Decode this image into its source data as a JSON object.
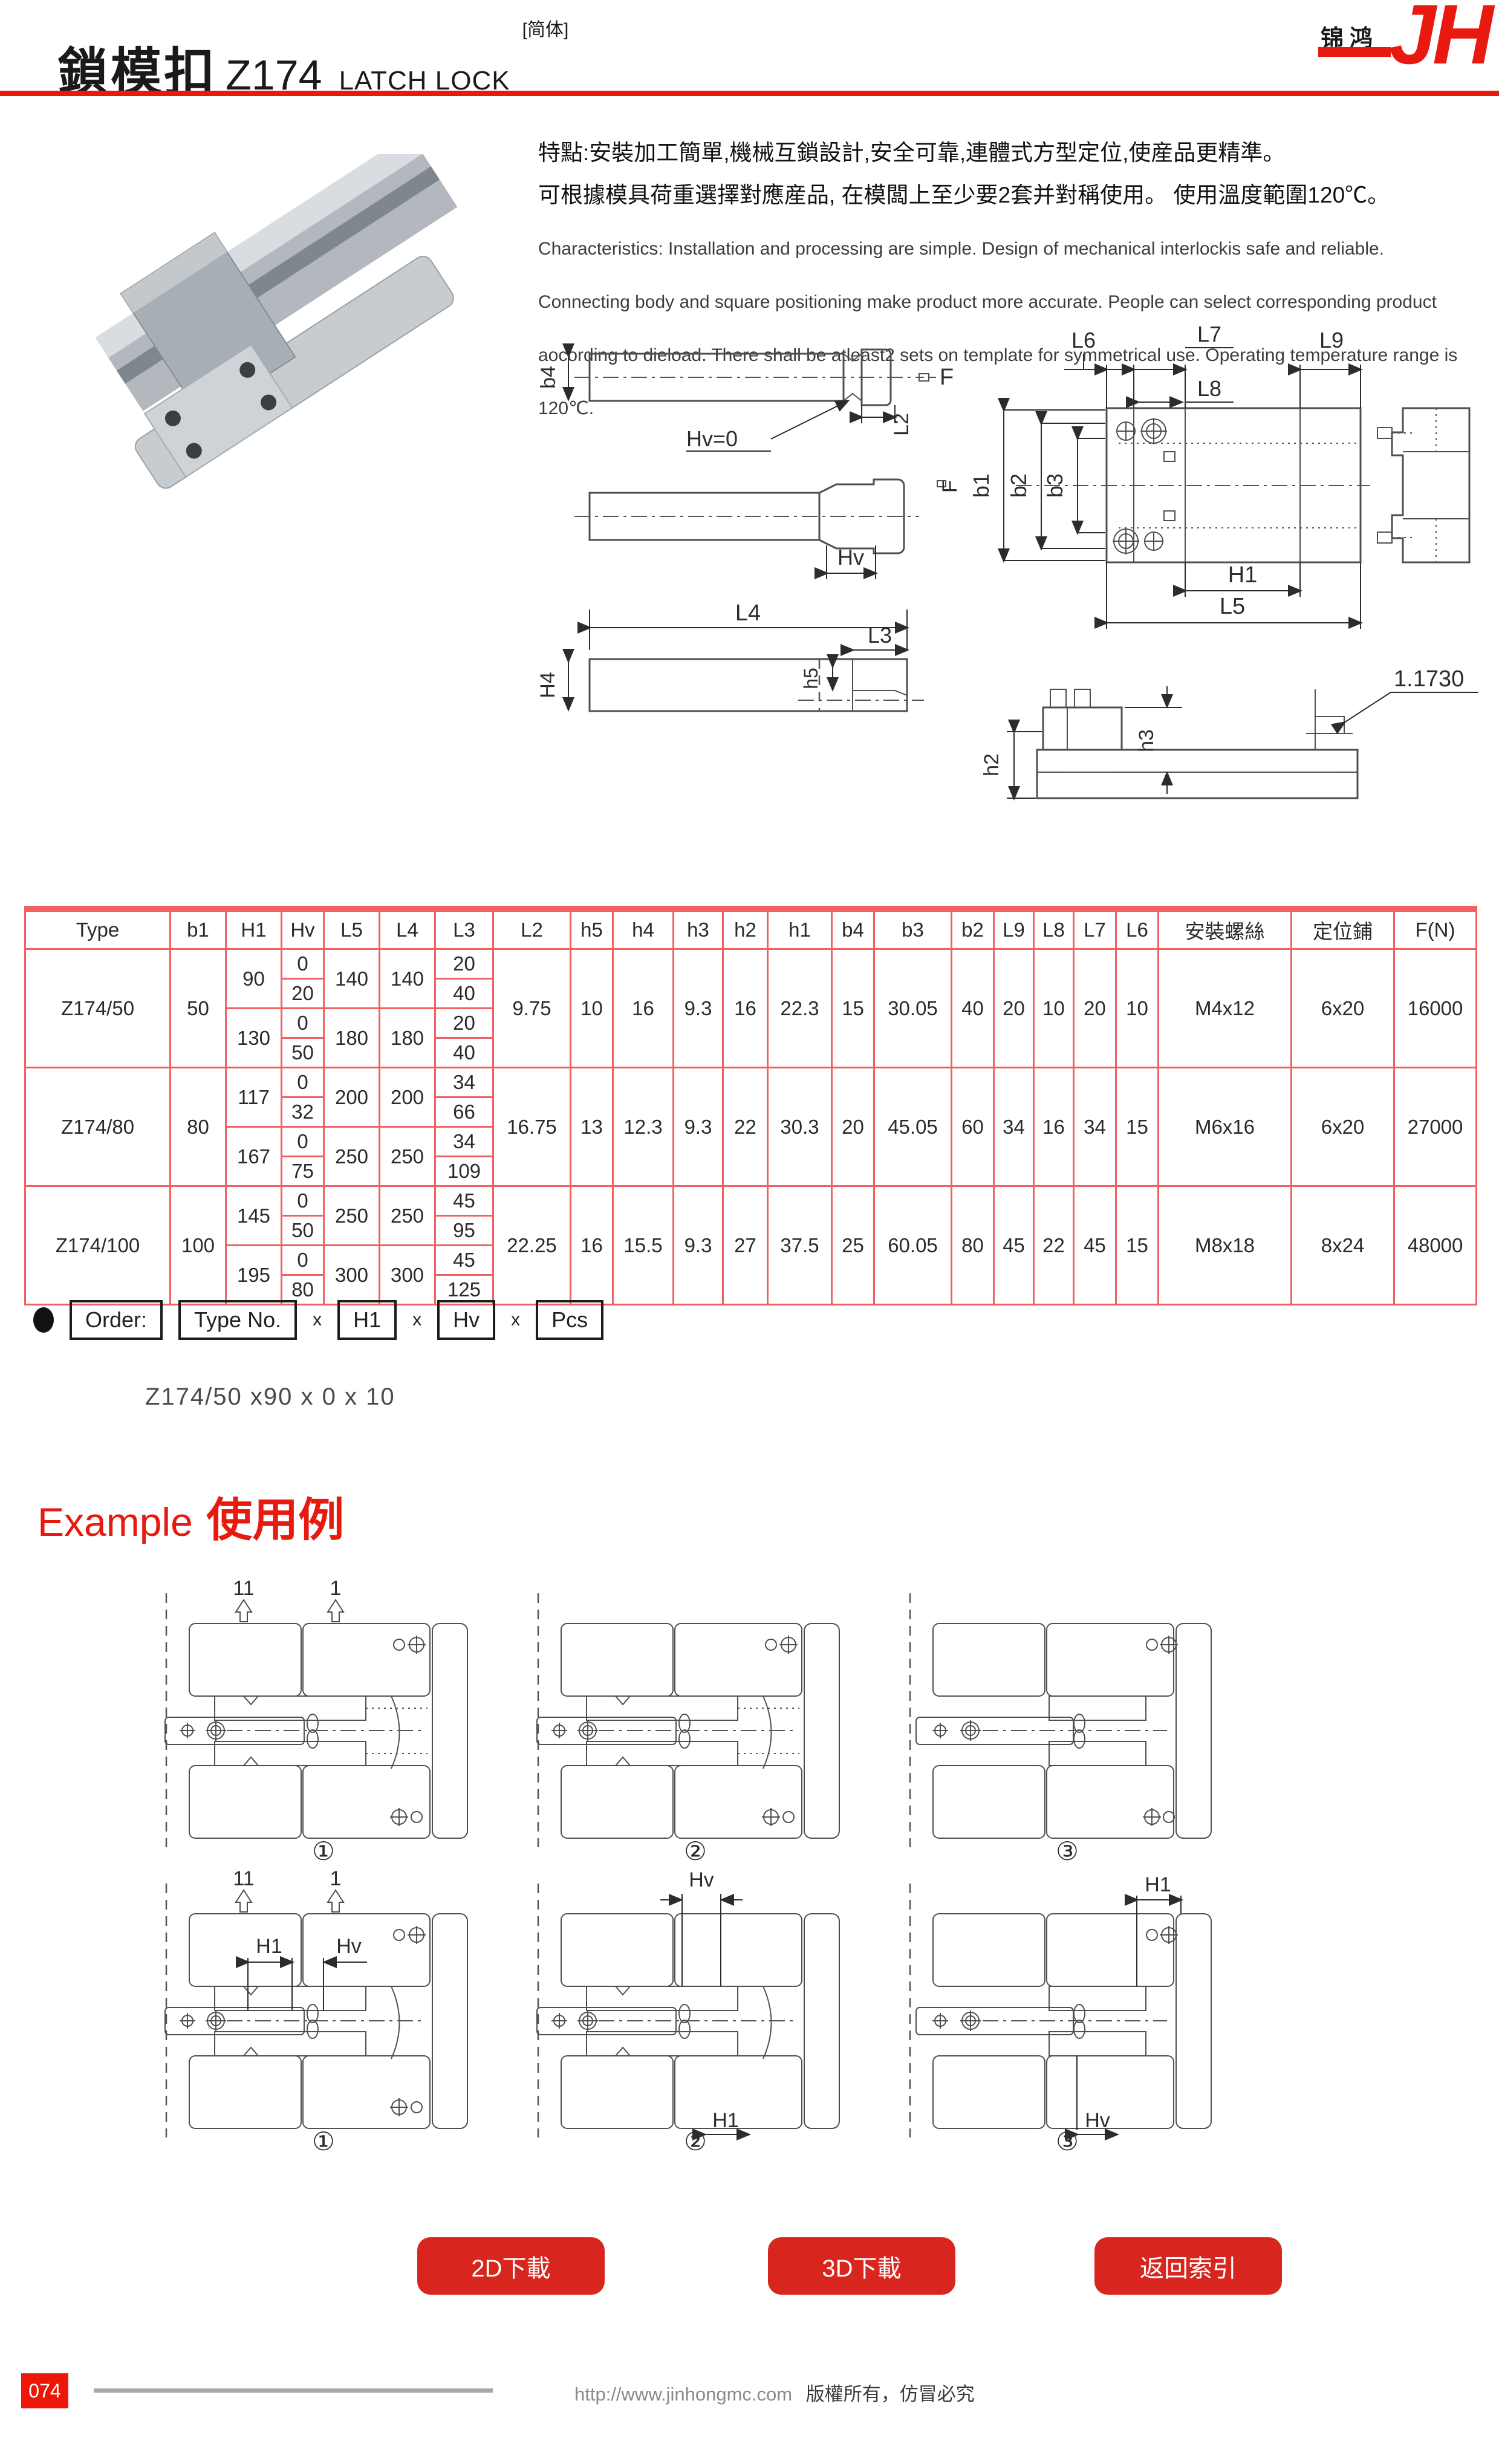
{
  "header": {
    "title_zh": "鎖模扣",
    "model": "Z174",
    "title_en": "LATCH LOCK",
    "tag": "[简体]",
    "logo_cn": "锦鸿",
    "logo_en": "JH"
  },
  "intro": {
    "line1": "特點:安裝加工簡單,機械互鎖設計,安全可靠,連體式方型定位,使産品更精準。",
    "line2": "可根據模具荷重選擇對應産品, 在模闆上至少要2套并對稱使用。 使用溫度範圍120℃。",
    "en": "Characteristics: Installation and processing are simple. Design of mechanical interlockis safe and reliable. Connecting body and square positioning make product more accurate. People can select corresponding product aocording to dieload. There shall be atleast2 sets on template for symmetrical use. Operating temperature range is 120℃."
  },
  "drawings": {
    "front": {
      "b4": "b4",
      "hv0": "Hv=0",
      "L2": "L2",
      "F": "F",
      "Hv": "Hv",
      "L4": "L4",
      "L3": "L3",
      "H4": "H4",
      "h5": "h5"
    },
    "top": {
      "L6": "L6",
      "L7": "L7",
      "L8": "L8",
      "L9": "L9",
      "b1": "b1",
      "b2": "b2",
      "b3": "b3",
      "F": "F",
      "H1": "H1",
      "L5": "L5"
    },
    "section": {
      "h2": "h2",
      "h3": "h3",
      "note": "1.1730"
    }
  },
  "table": {
    "headers": [
      "Type",
      "b1",
      "H1",
      "Hv",
      "L5",
      "L4",
      "L3",
      "L2",
      "h5",
      "h4",
      "h3",
      "h2",
      "h1",
      "b4",
      "b3",
      "b2",
      "L9",
      "L8",
      "L7",
      "L6",
      "安裝螺絲",
      "定位鋪",
      "F(N)"
    ],
    "groups": [
      {
        "type": "Z174/50",
        "b1": "50",
        "sub": [
          {
            "H1": "90",
            "L5": "140",
            "L4": "140",
            "rows": [
              {
                "Hv": "0",
                "L3": "20"
              },
              {
                "Hv": "20",
                "L3": "40"
              }
            ]
          },
          {
            "H1": "130",
            "L5": "180",
            "L4": "180",
            "rows": [
              {
                "Hv": "0",
                "L3": "20"
              },
              {
                "Hv": "50",
                "L3": "40"
              }
            ]
          }
        ],
        "shared": {
          "L2": "9.75",
          "h5": "10",
          "h4": "16",
          "h3": "9.3",
          "h2": "16",
          "h1": "22.3",
          "b4": "15",
          "b3": "30.05",
          "b2": "40",
          "L9": "20",
          "L8": "10",
          "L7": "20",
          "L6": "10",
          "screw": "M4x12",
          "pin": "6x20",
          "FN": "16000"
        }
      },
      {
        "type": "Z174/80",
        "b1": "80",
        "sub": [
          {
            "H1": "117",
            "L5": "200",
            "L4": "200",
            "rows": [
              {
                "Hv": "0",
                "L3": "34"
              },
              {
                "Hv": "32",
                "L3": "66"
              }
            ]
          },
          {
            "H1": "167",
            "L5": "250",
            "L4": "250",
            "rows": [
              {
                "Hv": "0",
                "L3": "34"
              },
              {
                "Hv": "75",
                "L3": "109"
              }
            ]
          }
        ],
        "shared": {
          "L2": "16.75",
          "h5": "13",
          "h4": "12.3",
          "h3": "9.3",
          "h2": "22",
          "h1": "30.3",
          "b4": "20",
          "b3": "45.05",
          "b2": "60",
          "L9": "34",
          "L8": "16",
          "L7": "34",
          "L6": "15",
          "screw": "M6x16",
          "pin": "6x20",
          "FN": "27000"
        }
      },
      {
        "type": "Z174/100",
        "b1": "100",
        "sub": [
          {
            "H1": "145",
            "L5": "250",
            "L4": "250",
            "rows": [
              {
                "Hv": "0",
                "L3": "45"
              },
              {
                "Hv": "50",
                "L3": "95"
              }
            ]
          },
          {
            "H1": "195",
            "L5": "300",
            "L4": "300",
            "rows": [
              {
                "Hv": "0",
                "L3": "45"
              },
              {
                "Hv": "80",
                "L3": "125"
              }
            ]
          }
        ],
        "shared": {
          "L2": "22.25",
          "h5": "16",
          "h4": "15.5",
          "h3": "9.3",
          "h2": "27",
          "h1": "37.5",
          "b4": "25",
          "b3": "60.05",
          "b2": "80",
          "L9": "45",
          "L8": "22",
          "L7": "45",
          "L6": "15",
          "screw": "M8x18",
          "pin": "8x24",
          "FN": "48000"
        }
      }
    ]
  },
  "order": {
    "boxes": [
      "Order:",
      "Type No.",
      "H1",
      "Hv",
      "Pcs"
    ],
    "sep": "x",
    "example": "Z174/50 x90 x 0 x 10"
  },
  "example": {
    "heading_en": "Example",
    "heading_zh": "使用例",
    "labels": {
      "pos11": "11",
      "pos1": "1",
      "H1": "H1",
      "Hv": "Hv"
    },
    "numbers": [
      "①",
      "②",
      "③"
    ]
  },
  "buttons": {
    "dl2d": "2D下載",
    "dl3d": "3D下載",
    "back_index": "返回索引"
  },
  "footer": {
    "page": "074",
    "url": "http://www.jinhongmc.com",
    "copyright": "版權所有，仿冒必究"
  },
  "colors": {
    "accent_red": "#e8190f",
    "button_red": "#d8251d",
    "table_border": "#f26161"
  }
}
